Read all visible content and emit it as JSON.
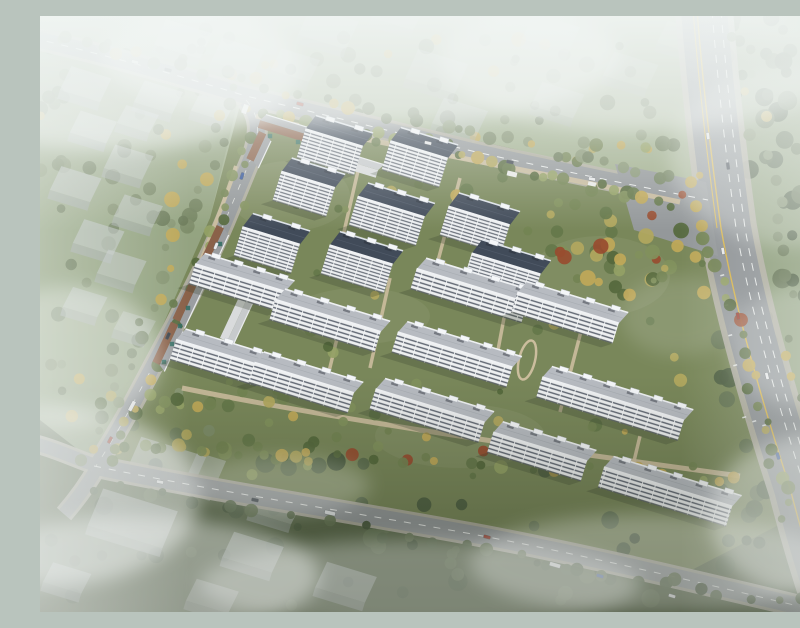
{
  "meta": {
    "scene": "aerial-architectural-rendering-residential-development",
    "width": 800,
    "height": 596
  },
  "palette": {
    "bg_stops": [
      [
        0,
        "#c9d3cf"
      ],
      [
        0.22,
        "#a9b695"
      ],
      [
        0.5,
        "#8d9b74"
      ],
      [
        0.78,
        "#6f7e57"
      ],
      [
        1,
        "#59654a"
      ]
    ],
    "asphalt": "#95999b",
    "artery_asphalt": "#8f9396",
    "casing": "#b2afa4",
    "tan_path": "#cbbd9d",
    "lawn": "#79875a",
    "lawn_light": "#87936a",
    "top_field": "#9fae8c",
    "left_field": "#93a381",
    "right_field": "#8d9d7a",
    "bottom_field": "#5a684a",
    "ctx_roof": "#c5cacc",
    "ctx_face": "#a7adaf",
    "mist": "#f4f7f6",
    "yellow_line": "#d9b64e",
    "white_line": "#e8eae9",
    "awning": "#2f6b60",
    "accent_tree": "#984c2f",
    "autumn_tree": "#c0a858"
  },
  "facade_patterns": {
    "fTall": {
      "w": 12,
      "h": 3.4,
      "wall": "#eceef0",
      "bandY": 2.1,
      "bandH": 1.1,
      "band": "#5e6570",
      "pierW": 0.8,
      "pier": "#f3f5f6"
    },
    "fMid": {
      "w": 13,
      "h": 4.3,
      "wall": "#edeff0",
      "bandY": 2.7,
      "bandH": 1.4,
      "band": "#606772",
      "pierW": 0.9,
      "pier": "#f3f5f6"
    }
  },
  "regions": [
    {
      "name": "far-field-north",
      "rect": [
        0,
        0,
        800,
        178
      ],
      "fill": "#9fae8c",
      "op": 0.95
    },
    {
      "name": "field-west",
      "points": "0,28 200,76 168,210 112,350 55,444 0,432",
      "fill": "#93a381",
      "op": 0.9
    },
    {
      "name": "field-east-of-artery",
      "points": "692,0 700,120 716,212 730,292 756,382 785,472 800,520 800,0",
      "fill": "#8d9d7a",
      "op": 1
    },
    {
      "name": "field-south",
      "points": "0,404 54,446 240,480 430,518 620,564 810,610 810,596 0,596",
      "fill": "#5a684a",
      "op": 1
    },
    {
      "name": "compound-lawn",
      "points": "204,74 470,132 664,180 686,250 706,330 732,420 756,500 640,560 420,514 220,478 54,446 118,320 170,202",
      "fill": "#79875a",
      "op": 1
    }
  ],
  "lawn_patches": [
    [
      560,
      260,
      70,
      40
    ],
    [
      250,
      180,
      60,
      35
    ],
    [
      420,
      420,
      85,
      32
    ],
    [
      320,
      300,
      70,
      28
    ]
  ],
  "tree_masses": [
    {
      "name": "canopy-north",
      "rect": [
        0,
        8,
        660,
        140
      ],
      "n": 80,
      "seed": 21,
      "pal": "muted",
      "rmin": 4,
      "rmax": 8
    },
    {
      "name": "canopy-east",
      "rect": [
        680,
        0,
        120,
        560
      ],
      "n": 78,
      "seed": 22,
      "pal": "dark",
      "rmin": 5,
      "rmax": 10
    },
    {
      "name": "canopy-south",
      "rect": [
        0,
        440,
        800,
        150
      ],
      "n": 62,
      "seed": 23,
      "pal": "dark",
      "rmin": 5,
      "rmax": 10
    },
    {
      "name": "canopy-west",
      "rect": [
        0,
        130,
        190,
        300
      ],
      "n": 40,
      "seed": 24,
      "pal": "muted",
      "rmin": 4,
      "rmax": 8
    },
    {
      "name": "canopy-ne-court",
      "rect": [
        480,
        185,
        170,
        95
      ],
      "n": 42,
      "seed": 25,
      "pal": "bright",
      "rmin": 4,
      "rmax": 8
    },
    {
      "name": "canopy-inner",
      "rect": [
        170,
        120,
        500,
        340
      ],
      "n": 95,
      "seed": 26,
      "pal": "bright",
      "rmin": 3,
      "rmax": 7
    },
    {
      "name": "canopy-sw-court",
      "rect": [
        60,
        380,
        330,
        70
      ],
      "n": 30,
      "seed": 27,
      "pal": "bright",
      "rmin": 4,
      "rmax": 7
    }
  ],
  "tree_belts": [
    {
      "name": "belt-north-outer",
      "x1": 0,
      "y1": 16,
      "x2": 650,
      "y2": 168,
      "n": 40,
      "seed": 11,
      "pal": "muted",
      "spread": 10
    },
    {
      "name": "belt-north-inner",
      "x1": 212,
      "y1": 94,
      "x2": 650,
      "y2": 192,
      "n": 34,
      "seed": 12,
      "pal": "bright",
      "spread": 9
    },
    {
      "name": "belt-artery-west",
      "x1": 666,
      "y1": 210,
      "x2": 748,
      "y2": 500,
      "n": 22,
      "seed": 13,
      "pal": "bright",
      "spread": 8
    },
    {
      "name": "belt-artery-east",
      "x1": 700,
      "y1": 20,
      "x2": 796,
      "y2": 520,
      "n": 26,
      "seed": 14,
      "pal": "muted",
      "spread": 16
    },
    {
      "name": "belt-west-outer",
      "x1": 198,
      "y1": 70,
      "x2": 48,
      "y2": 444,
      "n": 26,
      "seed": 15,
      "pal": "muted",
      "spread": 9
    },
    {
      "name": "belt-west-inner",
      "x1": 215,
      "y1": 120,
      "x2": 72,
      "y2": 446,
      "n": 24,
      "seed": 16,
      "pal": "bright",
      "spread": 8
    },
    {
      "name": "belt-south-inner",
      "x1": 80,
      "y1": 430,
      "x2": 700,
      "y2": 462,
      "n": 30,
      "seed": 17,
      "pal": "bright",
      "spread": 10
    },
    {
      "name": "belt-south-outer",
      "x1": 60,
      "y1": 470,
      "x2": 780,
      "y2": 592,
      "n": 32,
      "seed": 18,
      "pal": "dark",
      "spread": 12
    }
  ],
  "context_buildings": [
    [
      40,
      80,
      42,
      26,
      0.55
    ],
    [
      113,
      92,
      40,
      24,
      0.5
    ],
    [
      168,
      100,
      36,
      22,
      0.5
    ],
    [
      93,
      112,
      34,
      20,
      0.5
    ],
    [
      48,
      122,
      38,
      24,
      0.55
    ],
    [
      83,
      158,
      40,
      26,
      0.5
    ],
    [
      30,
      180,
      42,
      26,
      0.55
    ],
    [
      93,
      206,
      40,
      24,
      0.5
    ],
    [
      53,
      233,
      42,
      26,
      0.55
    ],
    [
      76,
      263,
      40,
      26,
      0.5
    ],
    [
      40,
      296,
      36,
      22,
      0.45
    ],
    [
      90,
      318,
      34,
      20,
      0.4
    ],
    [
      137,
      36,
      48,
      28,
      0.4
    ],
    [
      192,
      52,
      44,
      26,
      0.38
    ],
    [
      282,
      26,
      50,
      30,
      0.35
    ],
    [
      352,
      8,
      44,
      26,
      0.3
    ],
    [
      250,
      60,
      40,
      24,
      0.35
    ],
    [
      390,
      70,
      52,
      32,
      0.35
    ],
    [
      414,
      114,
      46,
      28,
      0.4
    ],
    [
      505,
      30,
      48,
      28,
      0.3
    ],
    [
      512,
      96,
      44,
      26,
      0.35
    ],
    [
      585,
      66,
      46,
      26,
      0.3
    ],
    [
      638,
      33,
      44,
      24,
      0.28
    ],
    [
      120,
      462,
      68,
      34,
      0.5
    ],
    [
      85,
      521,
      78,
      40,
      0.5
    ],
    [
      207,
      549,
      52,
      28,
      0.5
    ],
    [
      230,
      502,
      44,
      24,
      0.45
    ],
    [
      158,
      472,
      30,
      34,
      0.45
    ],
    [
      300,
      579,
      52,
      28,
      0.5
    ],
    [
      22,
      572,
      40,
      22,
      0.5
    ],
    [
      167,
      591,
      44,
      24,
      0.45
    ]
  ],
  "roads": [
    {
      "name": "north-boundary-road",
      "d": "M-8,22 C80,42 160,66 206,80 C290,100 362,118 432,135 C512,153 592,169 668,184",
      "w": 16,
      "casing": 22,
      "color": "#95999b"
    },
    {
      "name": "west-boundary-road",
      "d": "M206,84 C220,100 220,116 212,140 L188,198 C170,242 140,300 112,352 C96,382 76,420 56,450",
      "w": 15,
      "casing": 21,
      "color": "#95999b"
    },
    {
      "name": "west-exit-left",
      "d": "M58,450 C40,445 20,434 -4,428",
      "w": 13,
      "casing": 19,
      "color": "#95999b"
    },
    {
      "name": "west-exit-bottom",
      "d": "M58,450 C48,468 38,482 24,498",
      "w": 13,
      "casing": 19,
      "color": "#95999b"
    },
    {
      "name": "south-boundary-road",
      "d": "M54,450 C180,476 300,494 432,518 C545,539 662,567 800,600",
      "w": 17,
      "casing": 23,
      "color": "#95999b"
    },
    {
      "name": "main-artery",
      "d": "M664,-6 C670,70 678,140 688,212 C702,292 728,382 757,472 C768,515 780,555 794,596",
      "w": 46,
      "casing": 58,
      "color": "#8f9396"
    }
  ],
  "plaza": {
    "points": "575,148 666,166 678,240 594,214",
    "fill": "#94989a"
  },
  "road_markings": [
    {
      "d": "M-8,22 C80,42 160,66 206,80 C290,100 362,118 432,135 C512,153 592,169 668,184",
      "color": "#e8eae9",
      "w": 1,
      "dash": "7 8"
    },
    {
      "d": "M54,450 C180,476 300,494 432,518 C545,539 662,567 800,600",
      "color": "#e8eae9",
      "w": 1,
      "dash": "7 8"
    },
    {
      "d": "M206,84 C220,100 220,116 212,140 L188,198 C170,242 140,300 112,352 C96,382 76,420 56,450",
      "color": "#dadcd8",
      "w": 0.8,
      "dash": "6 9"
    },
    {
      "d": "M657,-6 C663,70 671,140 681,212 C695,292 721,382 750,472 C761,515 773,555 786,596",
      "color": "#d9b64e",
      "w": 1.4,
      "dash": ""
    },
    {
      "d": "M653,-6 C659,70 667,140 677,212",
      "color": "#d9b64e",
      "w": 1.1,
      "dash": ""
    },
    {
      "d": "M672,-6 C678,70 686,140 696,212 C710,292 736,382 765,472 C776,515 788,555 801,596",
      "color": "#e8eae9",
      "w": 1,
      "dash": "8 7"
    },
    {
      "d": "M681,-6 C687,70 695,140 705,212 C719,292 745,382 774,472 C785,515 797,555 810,596",
      "color": "#e8eae9",
      "w": 1,
      "dash": "8 7"
    }
  ],
  "lane_marks": [
    [
      684,
      258
    ],
    [
      688,
      288
    ],
    [
      692,
      318
    ],
    [
      706,
      400
    ],
    [
      716,
      404
    ],
    [
      726,
      408
    ],
    [
      697,
      348
    ]
  ],
  "inner_paths": [
    {
      "d": "M216,100 C330,126 470,150 640,186",
      "w": 5
    },
    {
      "d": "M142,372 C300,404 480,430 700,460",
      "w": 5
    },
    {
      "d": "M196,150 C180,200 150,270 128,330",
      "w": 4
    },
    {
      "d": "M320,146 L298,242",
      "w": 3.5
    },
    {
      "d": "M420,162 L395,256",
      "w": 3.5
    },
    {
      "d": "M350,262 L330,352",
      "w": 3.5
    },
    {
      "d": "M470,270 L455,350",
      "w": 3.5
    },
    {
      "d": "M545,300 L520,396",
      "w": 3.5
    },
    {
      "d": "M300,310 L285,372",
      "w": 3.5
    },
    {
      "d": "M600,420 L590,462",
      "w": 3.5
    }
  ],
  "feature_oval": {
    "cx": 487,
    "cy": 344,
    "rx": 8,
    "ry": 20,
    "rot": 14
  },
  "building_types": {
    "tall": {
      "H": 30,
      "D": 16,
      "roof": "#414b59",
      "roofEdge": "#dde2e8",
      "ridge": "#545e6d",
      "pattern": "fTall"
    },
    "mid": {
      "H": 21,
      "D": 13,
      "roof": "#b7bbc1",
      "roofEdge": "#eef0f2",
      "ridge": "#a6abb1",
      "pattern": "fMid"
    }
  },
  "buildings": [
    [
      294,
      122,
      60,
      "tall"
    ],
    [
      268,
      164,
      56,
      "tall"
    ],
    [
      379,
      134,
      60,
      "tall"
    ],
    [
      351,
      191,
      70,
      "tall"
    ],
    [
      439,
      200,
      64,
      "tall"
    ],
    [
      231,
      220,
      60,
      "tall"
    ],
    [
      321,
      239,
      66,
      "tall"
    ],
    [
      466,
      248,
      72,
      "tall"
    ],
    [
      200,
      262,
      94,
      "mid"
    ],
    [
      288,
      300,
      110,
      "mid"
    ],
    [
      432,
      270,
      116,
      "mid"
    ],
    [
      528,
      292,
      106,
      "mid"
    ],
    [
      179,
      337,
      90,
      "mid"
    ],
    [
      264,
      362,
      104,
      "mid"
    ],
    [
      415,
      334,
      120,
      "mid"
    ],
    [
      573,
      383,
      148,
      "mid"
    ],
    [
      390,
      390,
      114,
      "mid"
    ],
    [
      500,
      431,
      98,
      "mid"
    ],
    [
      628,
      471,
      134,
      "mid"
    ]
  ],
  "podiums": [
    [
      246,
      112,
      54,
      17,
      "brick"
    ],
    [
      220,
      132,
      30,
      115,
      "brick"
    ],
    [
      318,
      148,
      42,
      17,
      "light"
    ],
    [
      173,
      236,
      52,
      115,
      "brick"
    ],
    [
      150,
      284,
      48,
      115,
      "brick"
    ],
    [
      129,
      329,
      44,
      115,
      "brick"
    ],
    [
      199,
      300,
      56,
      115,
      "light"
    ]
  ],
  "awnings": [
    [
      168,
      250
    ],
    [
      160,
      268
    ],
    [
      148,
      292
    ],
    [
      140,
      310
    ],
    [
      132,
      328
    ],
    [
      124,
      346
    ],
    [
      180,
      228
    ],
    [
      230,
      120
    ],
    [
      258,
      126
    ]
  ],
  "kiosks": [
    [
      472,
      158,
      10,
      5,
      13
    ],
    [
      205,
      93,
      9,
      5,
      110
    ],
    [
      552,
      168,
      8,
      4,
      12
    ]
  ],
  "vehicles": [
    [
      95,
      46,
      14,
      "car",
      "#e8e9ea"
    ],
    [
      128,
      54,
      14,
      "car",
      "#3c434b"
    ],
    [
      260,
      88,
      15,
      "car",
      "#9c3a2c"
    ],
    [
      388,
      127,
      13,
      "car",
      "#e8e9ea"
    ],
    [
      470,
      146,
      12,
      "car",
      "#434a52"
    ],
    [
      552,
      163,
      11,
      "car",
      "#e8e9ea"
    ],
    [
      668,
      120,
      82,
      "car",
      "#e8e9ea"
    ],
    [
      688,
      150,
      82,
      "car",
      "#3c434b"
    ],
    [
      683,
      235,
      80,
      "car",
      "#e8e9ea"
    ],
    [
      698,
      300,
      78,
      "car",
      "#9c3a2c"
    ],
    [
      727,
      360,
      76,
      "car",
      "#e8e9ea"
    ],
    [
      738,
      440,
      74,
      "car",
      "#3a5a9c"
    ],
    [
      202,
      160,
      108,
      "car",
      "#3a5a9c"
    ],
    [
      176,
      230,
      112,
      "car",
      "#e8e9ea"
    ],
    [
      128,
      320,
      115,
      "car",
      "#3c434b"
    ],
    [
      92,
      390,
      118,
      "bus",
      "#e8e9ea"
    ],
    [
      70,
      424,
      118,
      "car",
      "#9c3a2c"
    ],
    [
      120,
      466,
      11,
      "car",
      "#e8e9ea"
    ],
    [
      215,
      484,
      12,
      "car",
      "#3c434b"
    ],
    [
      290,
      497,
      13,
      "bus",
      "#dfe2e4"
    ],
    [
      447,
      521,
      15,
      "car",
      "#9c3a2c"
    ],
    [
      515,
      549,
      16,
      "bus",
      "#e8e9ea"
    ],
    [
      560,
      560,
      16,
      "car",
      "#3a5a9c"
    ],
    [
      632,
      580,
      17,
      "car",
      "#e8e9ea"
    ]
  ],
  "mist_blobs": [
    [
      70,
      55,
      190,
      80,
      0.55
    ],
    [
      320,
      40,
      260,
      70,
      0.5
    ],
    [
      600,
      45,
      200,
      70,
      0.45
    ],
    [
      750,
      140,
      120,
      90,
      0.3
    ],
    [
      30,
      340,
      90,
      70,
      0.4
    ],
    [
      10,
      480,
      150,
      90,
      0.5
    ],
    [
      100,
      560,
      180,
      60,
      0.45
    ],
    [
      380,
      568,
      220,
      45,
      0.33
    ],
    [
      610,
      548,
      180,
      50,
      0.3
    ],
    [
      770,
      500,
      100,
      80,
      0.38
    ],
    [
      240,
      470,
      90,
      30,
      0.22
    ],
    [
      640,
      300,
      60,
      40,
      0.15
    ],
    [
      760,
      330,
      70,
      60,
      0.25
    ]
  ],
  "overlays_pre_mist": [
    {
      "rect": [
        0,
        360,
        800,
        236
      ],
      "x2": 0,
      "y2": 1,
      "stops": [
        [
          0,
          "rgba(30,36,22,0)"
        ],
        [
          1,
          "rgba(30,36,22,0.4)"
        ]
      ]
    }
  ],
  "overlays_post_mist": [
    {
      "rect": [
        0,
        0,
        800,
        215
      ],
      "x2": 0,
      "y2": 1,
      "stops": [
        [
          0,
          "rgba(243,247,246,0.88)"
        ],
        [
          0.5,
          "rgba(243,247,246,0.45)"
        ],
        [
          1,
          "rgba(243,247,246,0)"
        ]
      ]
    },
    {
      "rect": [
        0,
        0,
        150,
        596
      ],
      "x2": 1,
      "y2": 0,
      "stops": [
        [
          0,
          "rgba(240,245,243,0.4)"
        ],
        [
          1,
          "rgba(240,245,243,0)"
        ]
      ]
    },
    {
      "rect": [
        640,
        0,
        160,
        596
      ],
      "x2": 1,
      "y2": 0,
      "stops": [
        [
          0,
          "rgba(240,245,243,0)"
        ],
        [
          1,
          "rgba(240,245,243,0.34)"
        ]
      ]
    }
  ],
  "tree_palettes": {
    "bright": [
      "#55683c",
      "#65774a",
      "#738353",
      "#81905c",
      "#93a065",
      "#b2a75f"
    ],
    "muted": [
      "#6a7a58",
      "#748361",
      "#7e8c69",
      "#879472"
    ],
    "dark": [
      "#45553a",
      "#506044",
      "#5a6a4c",
      "#647353"
    ]
  }
}
